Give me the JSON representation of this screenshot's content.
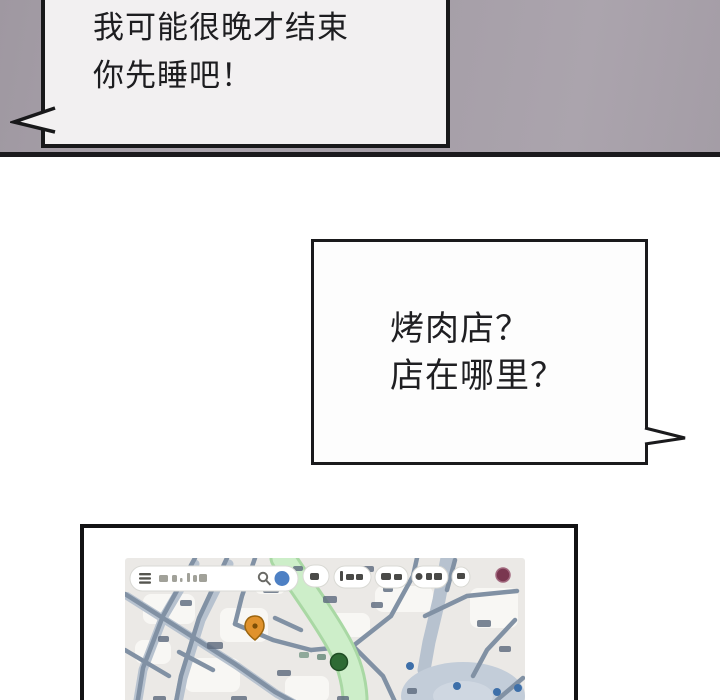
{
  "panels": {
    "top_bubble": {
      "lines": [
        "我可能很晚才结束",
        "你先睡吧！"
      ]
    },
    "question_bubble": {
      "lines": [
        "烤肉店？",
        "店在哪里？"
      ]
    }
  },
  "colors": {
    "panel_background": "#a8a1aa",
    "panel_divider": "#1b1a1d",
    "bubble_fill": "#f2f0f1",
    "bubble_border": "#18181a",
    "map_background": "#ebe9e6",
    "map_route_green": "#cdeec9",
    "map_route_green_edge": "#a9d8a4",
    "map_road_dark": "#8191a4",
    "map_road_light": "#b7c2cf",
    "map_junction_fill": "#c3cdd9",
    "marker_orange_pin": "#e0922c",
    "marker_green_circle": "#2e6b34",
    "marker_maroon_dot": "#7a3750",
    "poi_dot_blue": "#3d6fa9",
    "avatar_blue": "#4d80c4",
    "chip_fill": "#ffffff"
  },
  "map": {
    "search_bar": {
      "icons": [
        "hamburger-menu-icon",
        "search-icon",
        "account-avatar-dot"
      ],
      "text_state": "illegible-blurred"
    },
    "filter_chips_count": 5,
    "markers": [
      {
        "name": "orange-location-pin",
        "color": "#e0922c"
      },
      {
        "name": "green-circle-marker",
        "color": "#2e6b34"
      },
      {
        "name": "maroon-poi-dot",
        "color": "#7a3750"
      },
      {
        "name": "blue-poi-dots",
        "color": "#3d6fa9"
      }
    ]
  }
}
